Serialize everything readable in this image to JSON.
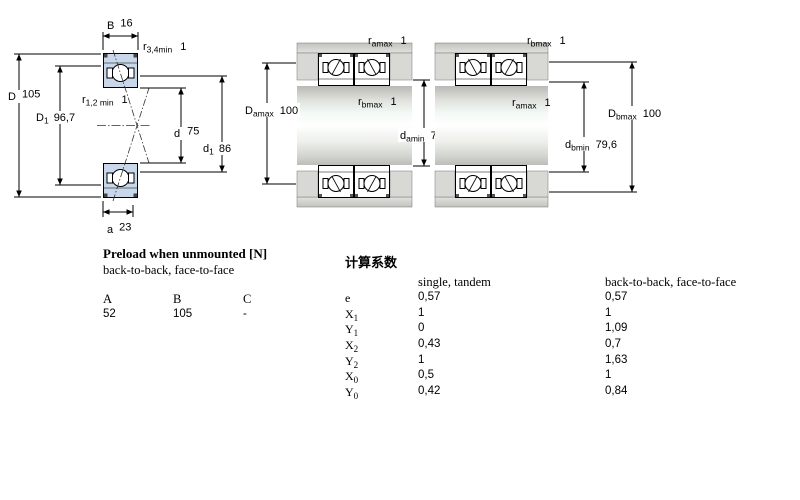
{
  "colors": {
    "bearing_section_fill": "#c9d7ea",
    "line": "#000000",
    "housing_gray": "#c8c8c4",
    "step_gray": "#d8d8d4"
  },
  "cross_section": {
    "labels": {
      "B": {
        "main": "B",
        "sub": "",
        "value": "16"
      },
      "r34": {
        "main": "r",
        "sub": "3,4min",
        "value": "1"
      },
      "D": {
        "main": "D",
        "sub": "",
        "value": "105"
      },
      "D1": {
        "main": "D",
        "sub": "1",
        "value": "96,7"
      },
      "r12": {
        "main": "r",
        "sub": "1,2 min",
        "value": "1"
      },
      "d": {
        "main": "d",
        "sub": "",
        "value": "75"
      },
      "d1": {
        "main": "d",
        "sub": "1",
        "value": "86"
      },
      "a": {
        "main": "a",
        "sub": "",
        "value": "23"
      }
    }
  },
  "arrangement_a": {
    "labels": {
      "ramax": {
        "main": "r",
        "sub": "amax",
        "value": "1"
      },
      "rbmax": {
        "main": "r",
        "sub": "bmax",
        "value": "1"
      },
      "Damax": {
        "main": "D",
        "sub": "amax",
        "value": "100"
      },
      "damin": {
        "main": "d",
        "sub": "amin",
        "value": "79,6"
      }
    }
  },
  "arrangement_b": {
    "labels": {
      "rbmax": {
        "main": "r",
        "sub": "bmax",
        "value": "1"
      },
      "ramax": {
        "main": "r",
        "sub": "amax",
        "value": "1"
      },
      "Dbmax": {
        "main": "D",
        "sub": "bmax",
        "value": "100"
      },
      "dbmin": {
        "main": "d",
        "sub": "bmin",
        "value": "79,6"
      }
    }
  },
  "preload_table": {
    "title": "Preload when unmounted [N]",
    "subtitle": "back-to-back, face-to-face",
    "columns": [
      "A",
      "B",
      "C"
    ],
    "values": [
      "52",
      "105",
      "-"
    ]
  },
  "factors_table": {
    "title": "计算系数",
    "col1_header": "single, tandem",
    "col2_header": "back-to-back, face-to-face",
    "rows": [
      {
        "label": "e",
        "sub": "",
        "v1": "0,57",
        "v2": "0,57"
      },
      {
        "label": "X",
        "sub": "1",
        "v1": "1",
        "v2": "1"
      },
      {
        "label": "Y",
        "sub": "1",
        "v1": "0",
        "v2": "1,09"
      },
      {
        "label": "X",
        "sub": "2",
        "v1": "0,43",
        "v2": "0,7"
      },
      {
        "label": "Y",
        "sub": "2",
        "v1": "1",
        "v2": "1,63"
      },
      {
        "label": "X",
        "sub": "0",
        "v1": "0,5",
        "v2": "1"
      },
      {
        "label": "Y",
        "sub": "0",
        "v1": "0,42",
        "v2": "0,84"
      }
    ]
  }
}
